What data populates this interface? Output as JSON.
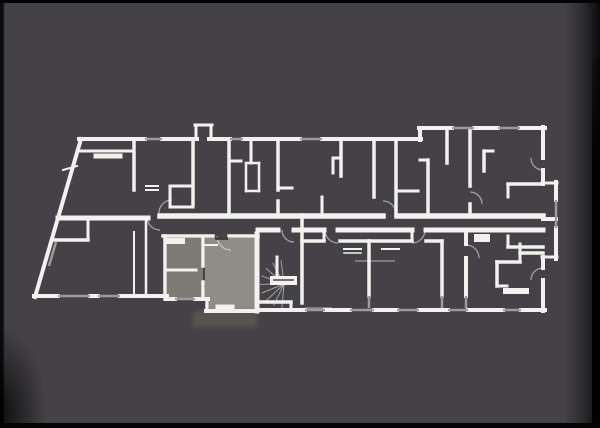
{
  "colors": {
    "background": "#454247",
    "letterbox": "#040404",
    "wall": "#f2f1ef",
    "window": "#9d9b99",
    "door_arc": "rgba(255,255,255,0.5)",
    "stair_ray": "rgba(255,255,255,0.5)",
    "thin_line": "rgba(255,255,255,0.4)",
    "highlight_main": "#908c86",
    "highlight_secondary": "#7d7a74",
    "highlight_terrace": "#595652",
    "door_leaf": "#434044",
    "landing_slot": "#454247"
  },
  "floorplan": {
    "walls": [
      [
        81,
        139,
        35,
        297,
        4
      ],
      [
        79,
        139,
        145,
        139,
        4
      ],
      [
        162,
        139,
        197,
        139,
        4
      ],
      [
        209,
        139,
        230,
        139,
        4
      ],
      [
        243,
        139,
        300,
        139,
        4
      ],
      [
        322,
        139,
        421,
        139,
        4
      ],
      [
        196,
        139,
        196,
        126,
        3
      ],
      [
        195,
        125,
        212,
        125,
        3
      ],
      [
        211,
        126,
        211,
        139,
        3
      ],
      [
        420,
        140,
        420,
        128,
        4
      ],
      [
        419,
        128,
        452,
        128,
        4
      ],
      [
        474,
        128,
        498,
        128,
        4
      ],
      [
        520,
        128,
        545,
        128,
        4
      ],
      [
        543,
        127,
        543,
        158,
        4
      ],
      [
        543,
        170,
        543,
        184,
        4
      ],
      [
        542,
        183,
        557,
        183,
        3
      ],
      [
        556,
        182,
        556,
        200,
        4
      ],
      [
        556,
        228,
        556,
        259,
        4
      ],
      [
        557,
        257,
        542,
        257,
        3
      ],
      [
        543,
        257,
        543,
        268,
        4
      ],
      [
        543,
        280,
        543,
        311,
        4
      ],
      [
        545,
        310,
        521,
        310,
        4
      ],
      [
        503,
        310,
        468,
        310,
        4
      ],
      [
        448,
        310,
        419,
        310,
        4
      ],
      [
        397,
        310,
        374,
        310,
        4
      ],
      [
        350,
        310,
        325,
        310,
        4
      ],
      [
        305,
        310,
        258,
        310,
        4
      ],
      [
        257,
        311,
        206,
        311,
        4
      ],
      [
        207,
        311,
        207,
        299,
        3
      ],
      [
        208,
        299,
        195,
        299,
        4
      ],
      [
        175,
        299,
        166,
        299,
        4
      ],
      [
        167,
        296,
        120,
        296,
        4
      ],
      [
        98,
        296,
        90,
        296,
        4
      ],
      [
        58,
        296,
        34,
        296,
        4
      ],
      [
        58,
        218,
        148,
        218,
        5
      ],
      [
        160,
        216,
        383,
        216,
        5.5
      ],
      [
        397,
        216,
        543,
        216,
        5.5
      ],
      [
        543,
        219,
        556,
        219,
        4
      ],
      [
        258,
        230,
        278,
        230,
        5
      ],
      [
        294,
        230,
        324,
        230,
        5
      ],
      [
        338,
        230,
        412,
        230,
        5
      ],
      [
        426,
        230,
        543,
        230,
        5
      ],
      [
        77,
        151,
        134,
        151,
        3
      ],
      [
        96,
        156,
        120,
        156,
        5
      ],
      [
        134,
        140,
        134,
        190,
        3.5
      ],
      [
        146,
        186,
        158,
        186,
        2
      ],
      [
        146,
        190,
        158,
        190,
        2
      ],
      [
        170,
        186,
        193,
        186,
        3
      ],
      [
        170,
        186,
        170,
        207,
        3
      ],
      [
        170,
        207,
        193,
        207,
        3
      ],
      [
        193,
        140,
        193,
        205,
        3.5
      ],
      [
        229,
        140,
        229,
        213,
        3.5
      ],
      [
        229,
        161,
        241,
        161,
        3
      ],
      [
        251,
        140,
        251,
        163,
        3
      ],
      [
        246,
        163,
        259,
        163,
        2.5
      ],
      [
        259,
        163,
        259,
        191,
        2.5
      ],
      [
        246,
        191,
        259,
        191,
        2.5
      ],
      [
        246,
        163,
        246,
        191,
        2.5
      ],
      [
        278,
        140,
        278,
        190,
        3.5
      ],
      [
        278,
        201,
        278,
        215,
        3.5
      ],
      [
        279,
        188,
        292,
        188,
        3
      ],
      [
        322,
        197,
        322,
        213,
        3
      ],
      [
        341,
        140,
        341,
        176,
        3.5
      ],
      [
        333,
        158,
        341,
        158,
        3
      ],
      [
        333,
        158,
        333,
        173,
        3
      ],
      [
        374,
        140,
        374,
        197,
        3.5
      ],
      [
        396,
        140,
        396,
        213,
        3.5
      ],
      [
        396,
        191,
        418,
        191,
        3
      ],
      [
        420,
        160,
        428,
        160,
        3
      ],
      [
        428,
        160,
        428,
        215,
        3.5
      ],
      [
        447,
        129,
        447,
        163,
        3.5
      ],
      [
        470,
        129,
        470,
        186,
        3.5
      ],
      [
        470,
        204,
        470,
        215,
        3.5
      ],
      [
        484,
        151,
        484,
        171,
        3.5
      ],
      [
        484,
        151,
        493,
        151,
        3
      ],
      [
        508,
        184,
        543,
        184,
        3.5
      ],
      [
        508,
        184,
        508,
        197,
        3
      ],
      [
        508,
        247,
        543,
        247,
        3.5
      ],
      [
        508,
        247,
        508,
        236,
        3
      ],
      [
        52,
        240,
        88,
        240,
        3.5
      ],
      [
        88,
        217,
        88,
        240,
        3
      ],
      [
        134,
        232,
        134,
        294,
        2
      ],
      [
        146,
        220,
        146,
        294,
        2.5
      ],
      [
        163,
        236,
        213,
        236,
        3.5
      ],
      [
        229,
        236,
        258,
        236,
        3.5
      ],
      [
        165,
        236,
        165,
        299,
        3.5
      ],
      [
        203,
        238,
        203,
        266,
        3.5
      ],
      [
        203,
        282,
        203,
        299,
        3.5
      ],
      [
        165,
        270,
        196,
        270,
        3
      ],
      [
        168,
        241,
        182,
        241,
        6
      ],
      [
        257,
        234,
        257,
        311,
        5
      ],
      [
        218,
        307,
        232,
        307,
        5
      ],
      [
        205,
        245,
        217,
        245,
        2
      ],
      [
        302,
        215,
        302,
        303,
        3.5
      ],
      [
        258,
        302,
        291,
        302,
        3.5
      ],
      [
        291,
        302,
        291,
        310,
        3
      ],
      [
        277,
        257,
        277,
        276,
        3
      ],
      [
        302,
        241,
        324,
        241,
        3.5
      ],
      [
        324,
        230,
        324,
        241,
        3
      ],
      [
        340,
        241,
        369,
        241,
        3.5
      ],
      [
        344,
        249,
        361,
        249,
        2
      ],
      [
        344,
        253,
        361,
        253,
        1.5
      ],
      [
        369,
        241,
        369,
        296,
        3.5
      ],
      [
        369,
        241,
        412,
        241,
        3.5
      ],
      [
        412,
        230,
        412,
        241,
        3
      ],
      [
        426,
        241,
        442,
        241,
        3.5
      ],
      [
        382,
        249,
        399,
        249,
        2
      ],
      [
        442,
        241,
        442,
        296,
        3.5
      ],
      [
        466,
        230,
        466,
        244,
        4
      ],
      [
        466,
        258,
        466,
        296,
        4
      ],
      [
        478,
        238,
        486,
        238,
        8
      ],
      [
        497,
        262,
        520,
        262,
        3.5
      ],
      [
        497,
        262,
        497,
        286,
        3.5
      ],
      [
        497,
        286,
        507,
        286,
        3
      ],
      [
        506,
        291,
        514,
        291,
        6
      ],
      [
        518,
        291,
        526,
        291,
        6
      ],
      [
        520,
        253,
        543,
        253,
        3.5
      ],
      [
        520,
        244,
        520,
        262,
        3
      ],
      [
        63,
        170,
        77,
        166,
        2
      ]
    ],
    "windows": [
      [
        145,
        139,
        162,
        139
      ],
      [
        230,
        139,
        243,
        139
      ],
      [
        300,
        139,
        322,
        139
      ],
      [
        452,
        128,
        474,
        128
      ],
      [
        498,
        128,
        520,
        128
      ],
      [
        556,
        200,
        556,
        228
      ],
      [
        521,
        310,
        503,
        310
      ],
      [
        468,
        310,
        448,
        310
      ],
      [
        419,
        310,
        397,
        310
      ],
      [
        374,
        310,
        350,
        310
      ],
      [
        325,
        310,
        305,
        310
      ],
      [
        195,
        299,
        175,
        299
      ],
      [
        120,
        296,
        98,
        296
      ],
      [
        90,
        296,
        58,
        296
      ],
      [
        369,
        296,
        369,
        308
      ],
      [
        442,
        296,
        442,
        308
      ],
      [
        466,
        296,
        466,
        308
      ],
      [
        56,
        242,
        49,
        266
      ]
    ],
    "door_arcs": [
      [
        160,
        217,
        13,
        90,
        180
      ],
      [
        172,
        213,
        13,
        180,
        270
      ],
      [
        383,
        214,
        13,
        270,
        360
      ],
      [
        338,
        230,
        13,
        90,
        180
      ],
      [
        412,
        230,
        13,
        0,
        90
      ],
      [
        231,
        236,
        14,
        90,
        180
      ],
      [
        294,
        230,
        12,
        90,
        180
      ],
      [
        466,
        258,
        13,
        270,
        360
      ],
      [
        470,
        204,
        12,
        270,
        360
      ],
      [
        543,
        158,
        12,
        90,
        180
      ],
      [
        543,
        280,
        12,
        180,
        270
      ]
    ],
    "thin_lines": [
      [
        355,
        261,
        395,
        261
      ],
      [
        305,
        308,
        332,
        308
      ]
    ],
    "door_leaves": [
      [
        215,
        237,
        13,
        3
      ]
    ],
    "stair": {
      "cx": 284,
      "cy": 284,
      "ray_len": 24,
      "ray_angles": [
        95,
        116,
        137,
        158,
        179,
        200,
        221,
        242,
        263
      ],
      "landing": [
        270,
        276,
        27,
        9
      ],
      "landing_slot": [
        273,
        280,
        294,
        280
      ]
    },
    "highlight": {
      "secondary_room": [
        167,
        238,
        36,
        61
      ],
      "main_room": [
        205,
        238,
        52,
        73
      ],
      "terrace": [
        193,
        311,
        64,
        16
      ]
    }
  }
}
